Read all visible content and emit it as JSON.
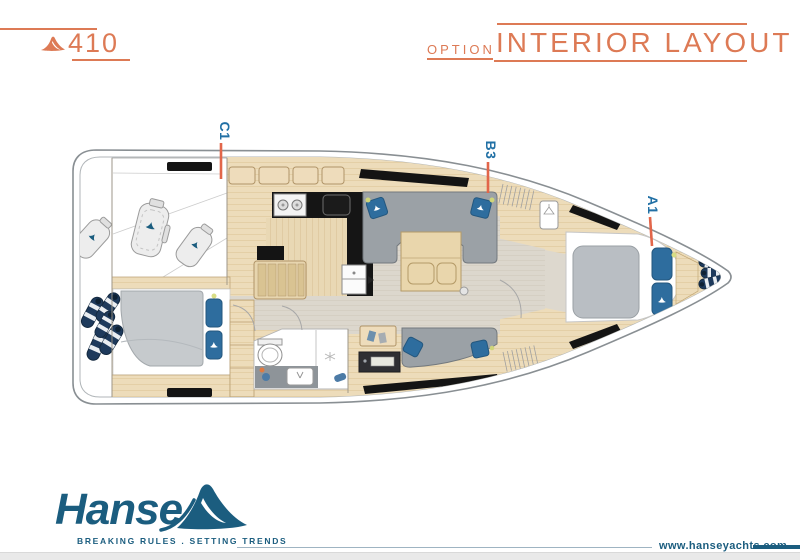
{
  "header": {
    "model": "410",
    "option_label": "OPTION",
    "title": "INTERIOR LAYOUT"
  },
  "plan": {
    "labels": [
      {
        "id": "C1"
      },
      {
        "id": "B3"
      },
      {
        "id": "A1"
      }
    ]
  },
  "footer": {
    "brand": "Hanse",
    "tagline": "BREAKING RULES . SETTING TRENDS",
    "website": "www.hanseyachts.com"
  },
  "colors": {
    "accent_orange": "#dd7a55",
    "leader_orange": "#e2664a",
    "label_blue": "#2170a5",
    "brand_teal": "#1b5d7f",
    "hull_outline": "#898f93",
    "wood": "#eddcba",
    "floor_gray": "#dcd7cd",
    "upholstery_gray": "#9ba1a6",
    "cushion_blue": "#2e6d9e",
    "window_black": "#141414",
    "fender_navy": "#1e3a5c"
  }
}
